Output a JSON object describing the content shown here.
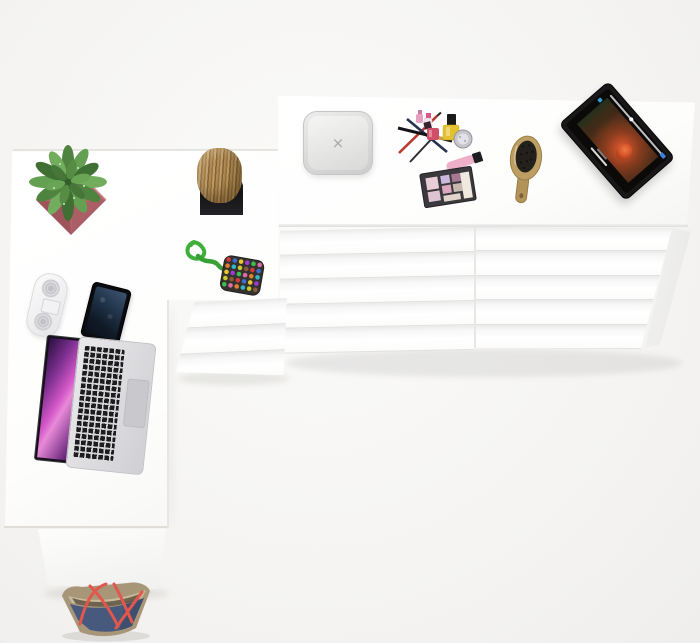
{
  "scene": {
    "description": "Top-down 3D product render of a white L-shaped desk combined with a wide chest of drawers, a three-drawer side unit and a pedestal, styled with lifestyle props",
    "background_color": "#f5f4f2",
    "furniture_color": "#ffffff"
  },
  "furniture": {
    "desk_surface": {
      "label": "White L-shaped desk top"
    },
    "drawer_chest": {
      "label": "Wide white chest of drawers",
      "columns": 2,
      "drawers_per_column": 5
    },
    "side_drawer_unit": {
      "label": "White three-drawer side unit",
      "drawers": 3
    },
    "desk_pedestal": {
      "label": "White desk pedestal panel"
    }
  },
  "objects": {
    "potted_plant": {
      "label": "Green speckled plant in pink square pot",
      "pot_color": "#b5656d",
      "leaf_color": "#5d9148"
    },
    "log_stool": {
      "label": "Rustic wooden log on black square base",
      "wood_color": "#a8854f",
      "base_color": "#1d1d1f"
    },
    "wireless_charger": {
      "label": "Grey square charging pad",
      "color": "#d9d9d8",
      "mark": "×"
    },
    "makeup_set": {
      "label": "Cosmetics set with pencils, brushes, nail polish, lip gloss and eyeshadow palette",
      "colors": [
        "#b8392e",
        "#26324f",
        "#e4c22f",
        "#d14f68",
        "#eeb0c9",
        "#b25a76",
        "#3b393d"
      ]
    },
    "eyeshadow_palette": {
      "label": "Eyeshadow palette with pink and mauve shades",
      "pan_colors": [
        "#e9ced8",
        "#cbb9dd",
        "#a87792",
        "#dba8c0",
        "#c8b8b0",
        "#efe9df"
      ]
    },
    "hairbrush": {
      "label": "Wooden oval hairbrush with dark bristles",
      "wood_color": "#bd9f63",
      "bristle_color": "#24211d"
    },
    "tablet": {
      "label": "Tablet on cyan stand playing a movie with a red-haired character",
      "bezel_color": "#18181a",
      "stand_color": "#35b0c9",
      "accent_color": "#3b82d8"
    },
    "keychain": {
      "label": "Green cord keychain with multicoloured beaded pouch",
      "cord_color": "#3fae3a",
      "bead_colors": [
        "#d23b3b",
        "#3b6fd2",
        "#e8c531",
        "#9b3bd2",
        "#3bbf4e",
        "#e06aae",
        "#e0802f",
        "#2fb7c9",
        "#c9c92f",
        "#8a5a3b"
      ]
    },
    "speaker": {
      "label": "White capsule speaker with twin grilles",
      "color": "#f4f4f5"
    },
    "smartphone": {
      "label": "Black smartphone with dark blue wallpaper",
      "screen_color": "#22364c"
    },
    "laptop": {
      "label": "Open silver laptop with purple abstract wallpaper",
      "body_color": "#d9d9dc",
      "wallpaper_colors": [
        "#7a2f8e",
        "#d457c8"
      ]
    },
    "tote_bag": {
      "label": "Denim tote bag with red straps and tan trim",
      "body_color": "#475a7d",
      "strap_color": "#e2574b",
      "trim_color": "#a89678"
    }
  }
}
